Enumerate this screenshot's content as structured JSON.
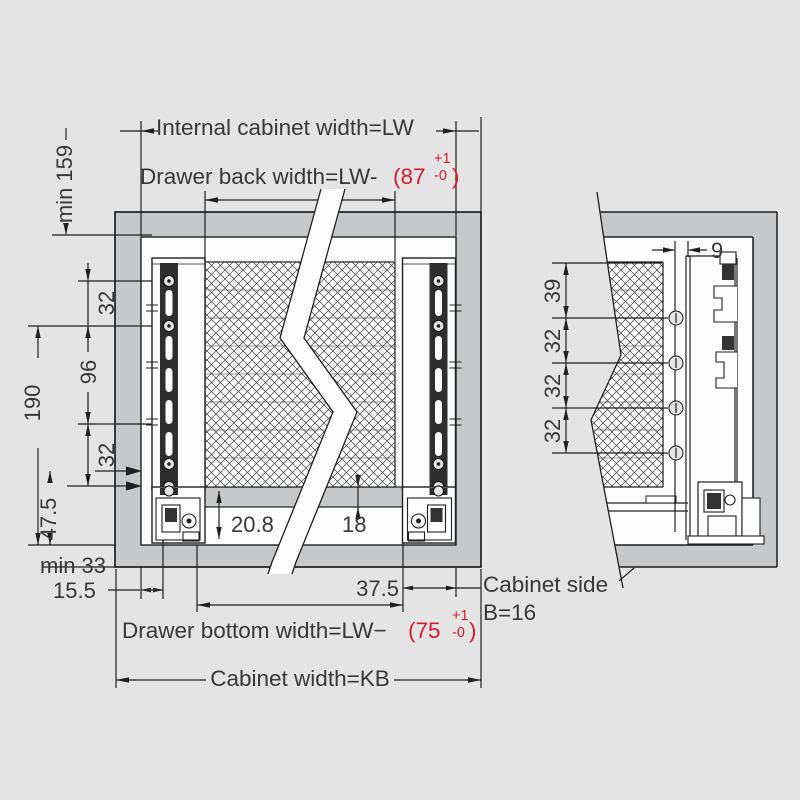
{
  "colors": {
    "background": "#e4e4e5",
    "cabinet_fill": "#c7c8ca",
    "line": "#1f1f1f",
    "text": "#383838",
    "tolerance_red": "#dc1a2e",
    "white": "#fdfdfd"
  },
  "labels": {
    "internal_cabinet_width": "Internal cabinet width=LW",
    "drawer_back_prefix": "Drawer back width=LW-",
    "drawer_back_value": "(87",
    "drawer_back_tol_plus": "+1",
    "drawer_back_tol_minus": "-0",
    "drawer_back_close": ")",
    "drawer_bottom_prefix": "Drawer bottom width=LW−",
    "drawer_bottom_value": "(75",
    "drawer_bottom_tol_plus": "+1",
    "drawer_bottom_tol_minus": "-0",
    "drawer_bottom_close": ")",
    "cabinet_width": "Cabinet width=KB",
    "cabinet_side_line1": "Cabinet side",
    "cabinet_side_line2": "B=16"
  },
  "dims_front": {
    "min159": "min 159",
    "gap32a": "32",
    "gap96": "96",
    "gap32b": "32",
    "h190": "190",
    "off47_5": "47.5",
    "min33": "min 33",
    "inset15_5": "15.5",
    "recess20_8": "20.8",
    "thick18": "18",
    "rear37_5": "37.5"
  },
  "dims_side": {
    "gap9": "9",
    "top39": "39",
    "p32a": "32",
    "p32b": "32",
    "p32c": "32"
  }
}
